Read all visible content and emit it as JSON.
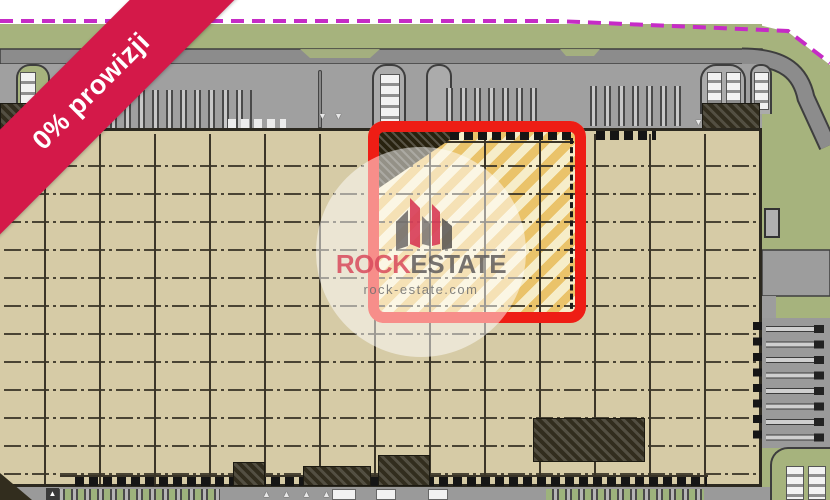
{
  "ribbon": {
    "label": "0% prowizji"
  },
  "watermark": {
    "brand_primary": "ROCK",
    "brand_secondary": "ESTATE",
    "domain": "rock-estate.com"
  },
  "icons": {
    "dock_door": "▪",
    "trailer_spot": "▮",
    "parking_stall": "▭",
    "entrance_marker_down": "▼",
    "entrance_marker_up": "▲"
  },
  "theme": {
    "ribbon-red": "#d41949",
    "highlight-red": "#ee1d15",
    "boundary-magenta": "#c62bc6",
    "grass": "#a6b37d",
    "road": "#8c8c8c",
    "apron": "#a0a0a0",
    "floor": "#d6cba6",
    "grid-line": "#3b3528",
    "hatch-gold": "#eac36a",
    "hatch-cream": "#f6edc9",
    "dark-block": "#322d1e",
    "brand-red": "#d84a5c",
    "brand-gray": "#5f5c5c"
  }
}
